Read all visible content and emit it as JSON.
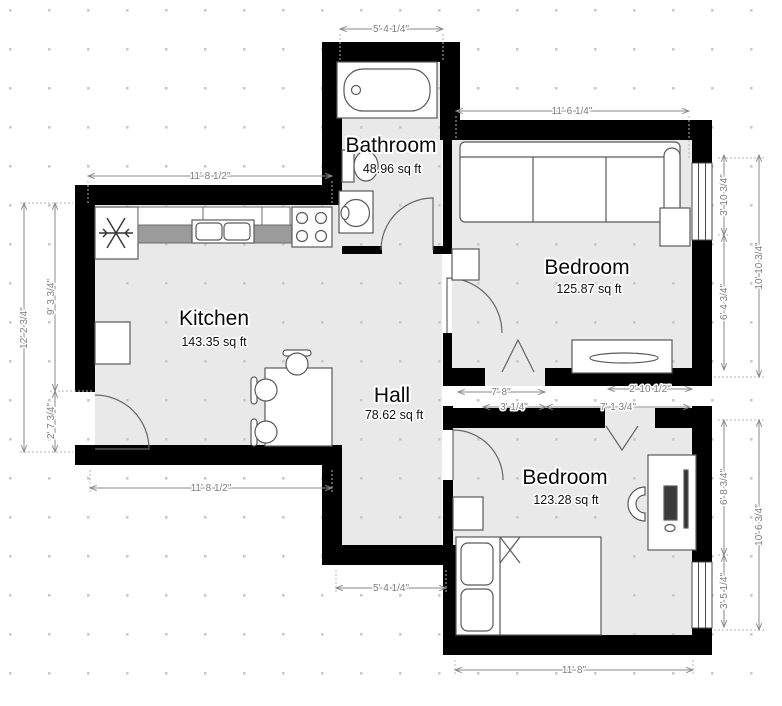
{
  "plan": {
    "rooms": {
      "bathroom": {
        "name": "Bathroom",
        "area": "48.96 sq ft"
      },
      "kitchen": {
        "name": "Kitchen",
        "area": "143.35 sq ft"
      },
      "hall": {
        "name": "Hall",
        "area": "78.62 sq ft"
      },
      "bedroom_top": {
        "name": "Bedroom",
        "area": "125.87 sq ft"
      },
      "bedroom_bottom": {
        "name": "Bedroom",
        "area": "123.28 sq ft"
      }
    },
    "dimensions": {
      "bathroom_top": "5' 4 1/4\"",
      "bedroom_top_width": "11' 6 1/4\"",
      "kitchen_top": "11' 8 1/2\"",
      "kitchen_bottom": "11' 8 1/2\"",
      "left_total": "12' 2 3/4\"",
      "left_upper": "9' 3 3/4\"",
      "left_door": "2' 7 3/4\"",
      "right_top_window": "3' 10 3/4\"",
      "right_top_lower": "6' 4 3/4\"",
      "right_top_total": "10' 10 3/4\"",
      "mid_row1_left": "7' 8\"",
      "mid_row1_right": "2' 10 1/2\"",
      "mid_row2_left": "3' 1/4\"",
      "mid_row2_right": "7' 1 3/4\"",
      "right_bottom_upper": "6' 8 3/4\"",
      "right_bottom_window": "3' 5 1/4\"",
      "right_bottom_total": "10' 6 3/4\"",
      "hall_bottom": "5' 4 1/4\"",
      "bedroom_bottom_width": "11' 8\""
    },
    "colors": {
      "wall": "#000000",
      "floor": "#e9e9e9",
      "dimension_line": "#8a8a8a",
      "counter": "#9b9b9b",
      "grid_dot": "#c9c9c9"
    }
  }
}
